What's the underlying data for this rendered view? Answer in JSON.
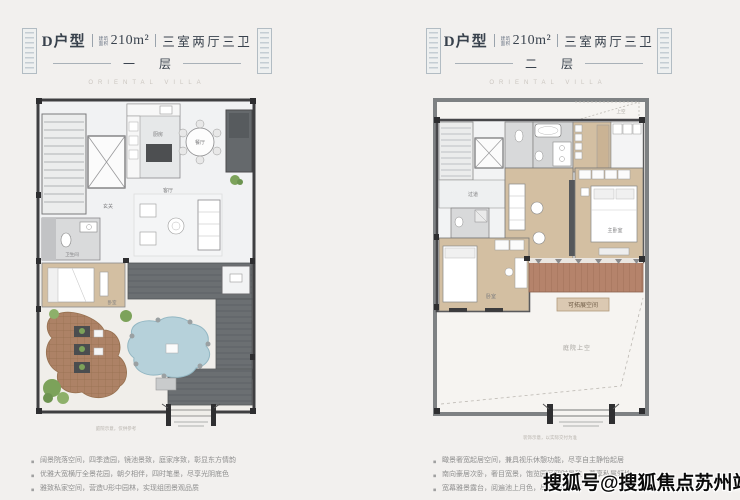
{
  "watermark": {
    "text": "搜狐号@搜狐焦点苏州站"
  },
  "colors": {
    "background": "#f2f0ee",
    "wall_dark": "#3f3f41",
    "wall_gray": "#7e8183",
    "marble": "#f1f2f3",
    "wood": "#d3bfa2",
    "deck": "#b5836b",
    "patio_brick": "#ad8266",
    "pond": "#b6d1da",
    "roof": "#6b6f72",
    "green": "#7ca25a",
    "title_text": "#39424d"
  },
  "left": {
    "header": {
      "unit": "D户型",
      "area_label_line1": "建筑",
      "area_label_line2": "面积",
      "area": "210m²",
      "layout": "三室两厅三卫",
      "floor": "一层"
    },
    "subtitle": "ORIENTAL VILLA",
    "rooms": {
      "kitchen": "厨房",
      "dining": "餐厅",
      "living": "客厅",
      "foyer": "玄关",
      "bath": "卫生间",
      "bedroom": "卧室"
    },
    "bullets": [
      "阔景院落空间，四季造园，镜池景致，庭家序致，彰显东方情韵",
      "优雅大宽横厅全景花园，朝夕相伴，四时笔墨，尽享光阴底色",
      "雅致私家空间，营造U形中园林，实现组团景观品质"
    ],
    "caption": "庭院示意，仅供参考"
  },
  "right": {
    "header": {
      "unit": "D户型",
      "area_label_line1": "建筑",
      "area_label_line2": "面积",
      "area": "210m²",
      "layout": "三室两厅三卫",
      "floor": "二层"
    },
    "subtitle": "ORIENTAL VILLA",
    "rooms": {
      "corridor": "过道",
      "master": "主卧室",
      "bedroom": "卧室",
      "terrace_expand": "可拓展空间",
      "courtyard_void": "庭院上空",
      "sky": "上空"
    },
    "bullets": [
      "瞰景奢宽起居空间，兼具视乐休憩功能，尽享自主静怡起居",
      "南向豪居次卧，奢目宽景，饱览园区四时景致，尊享私属领地",
      "宽幕雅景露台，阅遍池上月色，尽揽庭院风光"
    ],
    "caption": "装饰示意，以实际交付为准"
  }
}
